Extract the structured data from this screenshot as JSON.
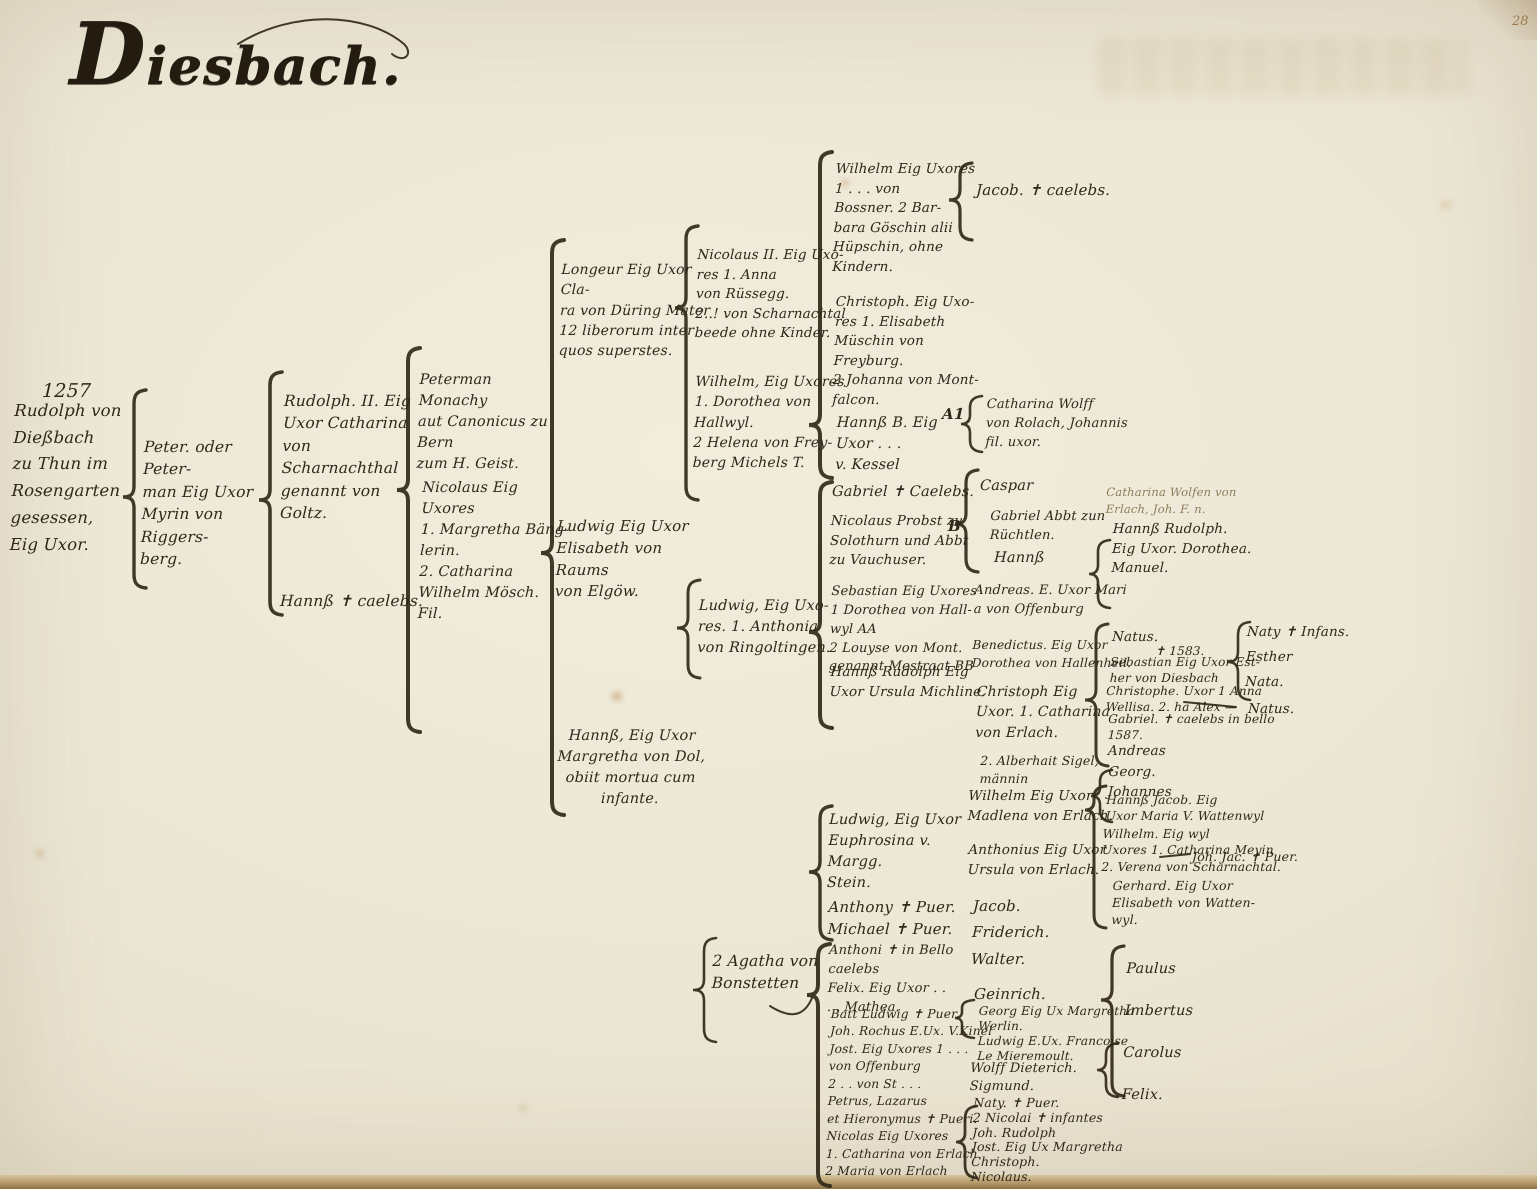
{
  "colors": {
    "paper": "#ece6d5",
    "ink": "#2f2718",
    "faded_ink": "#8d7c5a",
    "page_edge": "#8f7347"
  },
  "entries": {
    "title": "Diesbach.",
    "page_number": "28",
    "date_1257": "1257",
    "gen1_root": "Rudolph von\nDießbach\nzu Thun im\nRosengarten\ngesessen,\nEig Uxor.",
    "gen2_peter": "Peter. oder Peter-\nman Eig Uxor\nMyrin von Riggers-\nberg.",
    "gen3_rudolph2": "Rudolph. II. Eig\nUxor Catharina\nvon Scharnachthal\ngenannt von Goltz.",
    "gen3_hanns": "Hannß ✝ caelebs.",
    "gen4_peterman": "Peterman Monachy\naut Canonicus zu Bern\nzum H. Geist.",
    "gen4_nicolaus": "Nicolaus Eig Uxores\n1. Margretha Bäng-\nlerin.\n2. Catharina\nWilhelm Mösch. Fil.",
    "gen5_longeur": "Longeur Eig Uxor Cla-\nra von Düring Mater\n12 liberorum inter\nquos superstes.",
    "gen5_ludwig": "Ludwig Eig Uxor\nElisabeth von Raums\nvon Elgöw.",
    "gen5_hanns": "Hannß, Eig Uxor\nMargretha von Dol,\nobiit mortua cum\ninfante.",
    "gen6_nicolaus2": "Nicolaus II. Eig Uxo-\nres 1. Anna\nvon Rüssegg.\n2..! von Scharnachtal\nbeede ohne Kinder.",
    "gen6_wilhelm": "Wilhelm, Eig Uxores\n1. Dorothea von\nHallwyl.\n2 Helena von Frey-\nberg Michels T.",
    "gen6_ludwig": "Ludwig, Eig Uxo-\nres. 1. Anthonia\nvon Ringoltingen.",
    "gen6_agatha": "2 Agatha von\nBonstetten",
    "gen7_wilhelm": "Wilhelm Eig Uxores\n1 . . . von\nBossner. 2 Bar-\nbara Göschin alii\nHüpschin, ohne Kindern.",
    "gen7_christoph": "Christoph. Eig Uxo-\nres 1. Elisabeth\nMüschin von Freyburg.\n2 Johanna von Mont-\nfalcon.",
    "gen7_hanns": "Hannß B. Eig\nUxor . . .\nv. Kessel",
    "gen7_gabriel": "Gabriel ✝ Caelebs.",
    "gen7_nicolaus_probst": "Nicolaus Probst zu\nSolothurn und Abbt\nzu Vauchuser.",
    "gen7_sebastian": "Sebastian Eig Uxores\n1 Dorothea von Hall-\nwyl AA\n2 Louyse von Mont.\ngenannt Mestraat BB",
    "gen7_hanns_rudolph": "Hannß Rudolph Eig\nUxor Ursula Michline.",
    "gen7_ludwig": "Ludwig, Eig Uxor\nEuphrosina v. Margg.\nStein.",
    "gen7_anthony_michael": "Anthony ✝ Puer.\nMichael ✝ Puer.",
    "gen7_anthoni_felix": "Anthoni ✝ in Bello caelebs\nFelix. Eig Uxor . .\n. . Mathea.",
    "gen7_bottom_group": "Batt Ludwig ✝ Puer.\nJoh. Rochus E.Ux. V.Kinel\nJost. Eig Uxores 1 . . .\nvon Offenburg\n2 . . von St . . .\nPetrus, Lazarus\net Hieronymus ✝ Pueri.\nNicolas Eig Uxores\n1. Catharina von Erlach\n2 Maria von Erlach",
    "gen8_jacob_caelebs": "Jacob. ✝ caelebs.",
    "marker_a1": "A1",
    "gen8_catharina_wolff": "Catharina Wolff\nvon Rolach, Johannis\nfil. uxor.",
    "marker_b": "B",
    "gen8_caspar": "Caspar",
    "gen8_gabriel_abbt": "Gabriel Abbt zun\nRüchtlen.",
    "gen8_hanns": "Hannß",
    "gen8_andreas": "Andreas. E. Uxor Mari\na von Offenburg",
    "gen8_benedictus": "Benedictus. Eig Uxor\nDorothea von Hallenheil.",
    "gen8_christoph": "Christoph Eig\nUxor. 1. Catharina\nvon Erlach.",
    "gen8_alberhait": "2. Alberhait Sigel,\nmännin",
    "gen8_wilhelm_madlena": "Wilhelm Eig Uxor\nMadlena von Erlach.",
    "gen8_anthonius": "Anthonius Eig Uxor\nUrsula von Erlach.",
    "gen8_jacob_friderich_walter": "Jacob.\nFriderich.\nWalter.",
    "gen8_geinrich": "Geinrich.",
    "gen9_georg_ludwig": "Georg Eig Ux Margretha\nWerlin.\nLudwig E.Ux. Francoise\nLe Mieremoult.",
    "gen9_wolff_sigmund": "Wolff Dieterich.\nSigmund.",
    "gen9_naty_group": "Naty. ✝ Puer.\n2 Nicolai ✝ infantes\nJoh. Rudolph\nJost. Eig Ux Margretha\nChristoph.\nNicolaus.",
    "gen9_hanns_rudolph_manuel": "Hannß Rudolph.\nEig Uxor. Dorothea.\nManuel.",
    "gen9_natus": "Natus.",
    "gen9_natus_date": "✝ 1583.",
    "gen9_sebastian_esther": "Sebastian Eig Uxor Est-\nher von Diesbach",
    "gen9_christophe": "Christophe. Uxor 1 Anna\nWellisa. 2. ha Alex —",
    "gen9_gabriel_bello": "Gabriel. ✝ caelebs in bello\n1587.",
    "gen9_andreas": "Andreas",
    "gen9_georg_johannes": "Georg.\nJohannes",
    "gen9_hanns_jacob": "Hannß Jacob. Eig\nUxor Maria V. Wattenwyl",
    "gen9_wilhelm_meyin": "Wilhelm. Eig wyl\nUxores 1. Catharina Meyin\n2. Verena von Scharnachtal.",
    "gen9_gerhard": "Gerhard. Eig Uxor\nElisabeth von Watten-\nwyl.",
    "gen9_joh_jac_puer": "Joh. Jac. ✝ Puer.",
    "gen9_paulus_group": "Paulus\nImbertus\nCarolus\nFelix.",
    "gen10_naty_infans_group": "Naty ✝ Infans.\nEsther\nNata.",
    "gen10_natus": "Natus.",
    "note_catharina_wolfen": "Catharina Wolfen von\nErlach, Joh. F. n."
  }
}
